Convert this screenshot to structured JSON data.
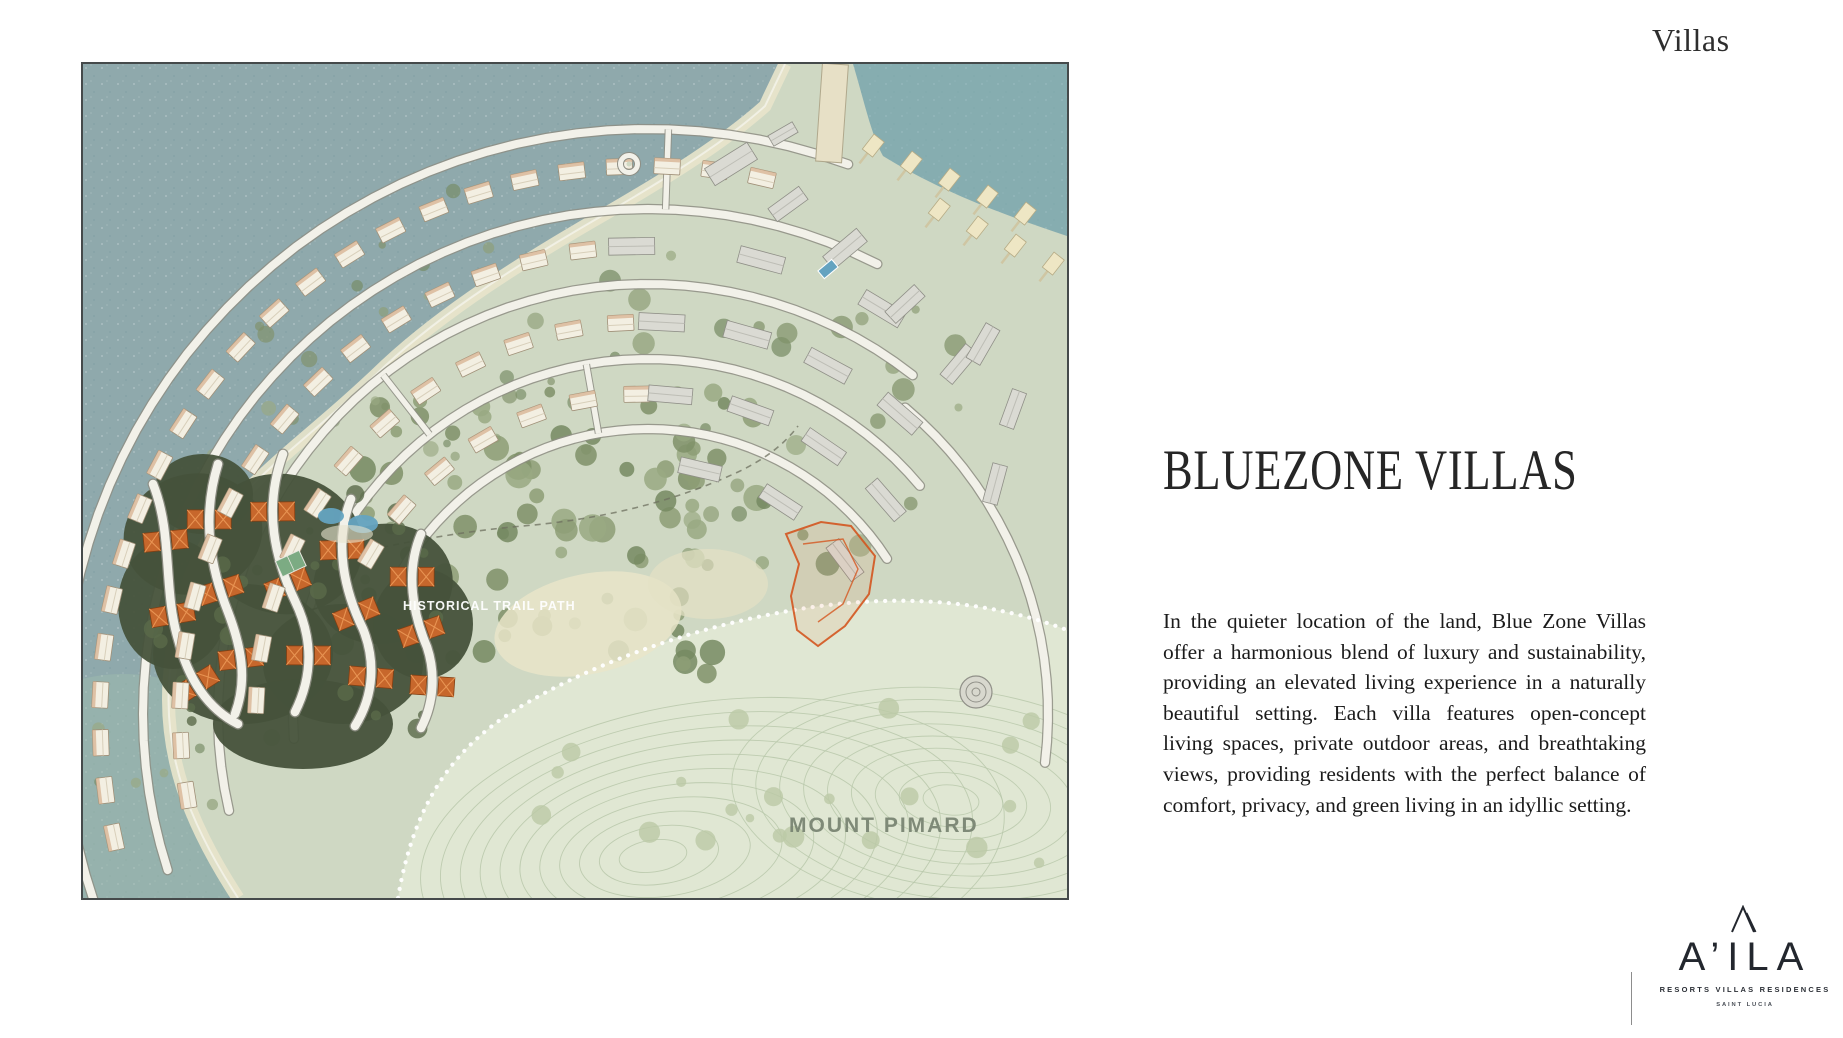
{
  "page": {
    "corner_label": "Villas"
  },
  "map": {
    "labels": {
      "trail": "HISTORICAL TRAIL PATH",
      "mount": "MOUNT PIMARD"
    },
    "colors": {
      "water": "#8fa9ac",
      "bay": "#7fb0b4",
      "water_green": "#9dbcae",
      "land": "#cfd8c3",
      "beach": "#e8e4cb",
      "road": "#f2f1e9",
      "road_edge": "#8e8e84",
      "forest": "#7f9168",
      "forest_dark": "#46523b",
      "hill": "#e0e7d3",
      "contour": "#b7c7a9",
      "villa": "#f3efe2",
      "villa_edge": "#a09078",
      "villa_orange": "#c7672c",
      "block": "#dadad3",
      "cabana": "#eee6c4",
      "pool": "#64a3c0",
      "scribble": "#d4561f",
      "trail_line": "#6e705f"
    }
  },
  "content": {
    "title": "BLUEZONE VILLAS",
    "body": "In the quieter location of the land, Blue Zone Villas offer a harmonious blend of luxury and sustainability, providing an elevated living experience in a naturally beautiful setting. Each villa features open-concept living spaces, private outdoor areas, and breathtaking views, providing residents with the perfect balance of comfort, privacy, and green living in an idyllic setting."
  },
  "logo": {
    "name": "A’ILA",
    "tagline": "RESORTS VILLAS RESIDENCES",
    "location": "SAINT LUCIA"
  }
}
